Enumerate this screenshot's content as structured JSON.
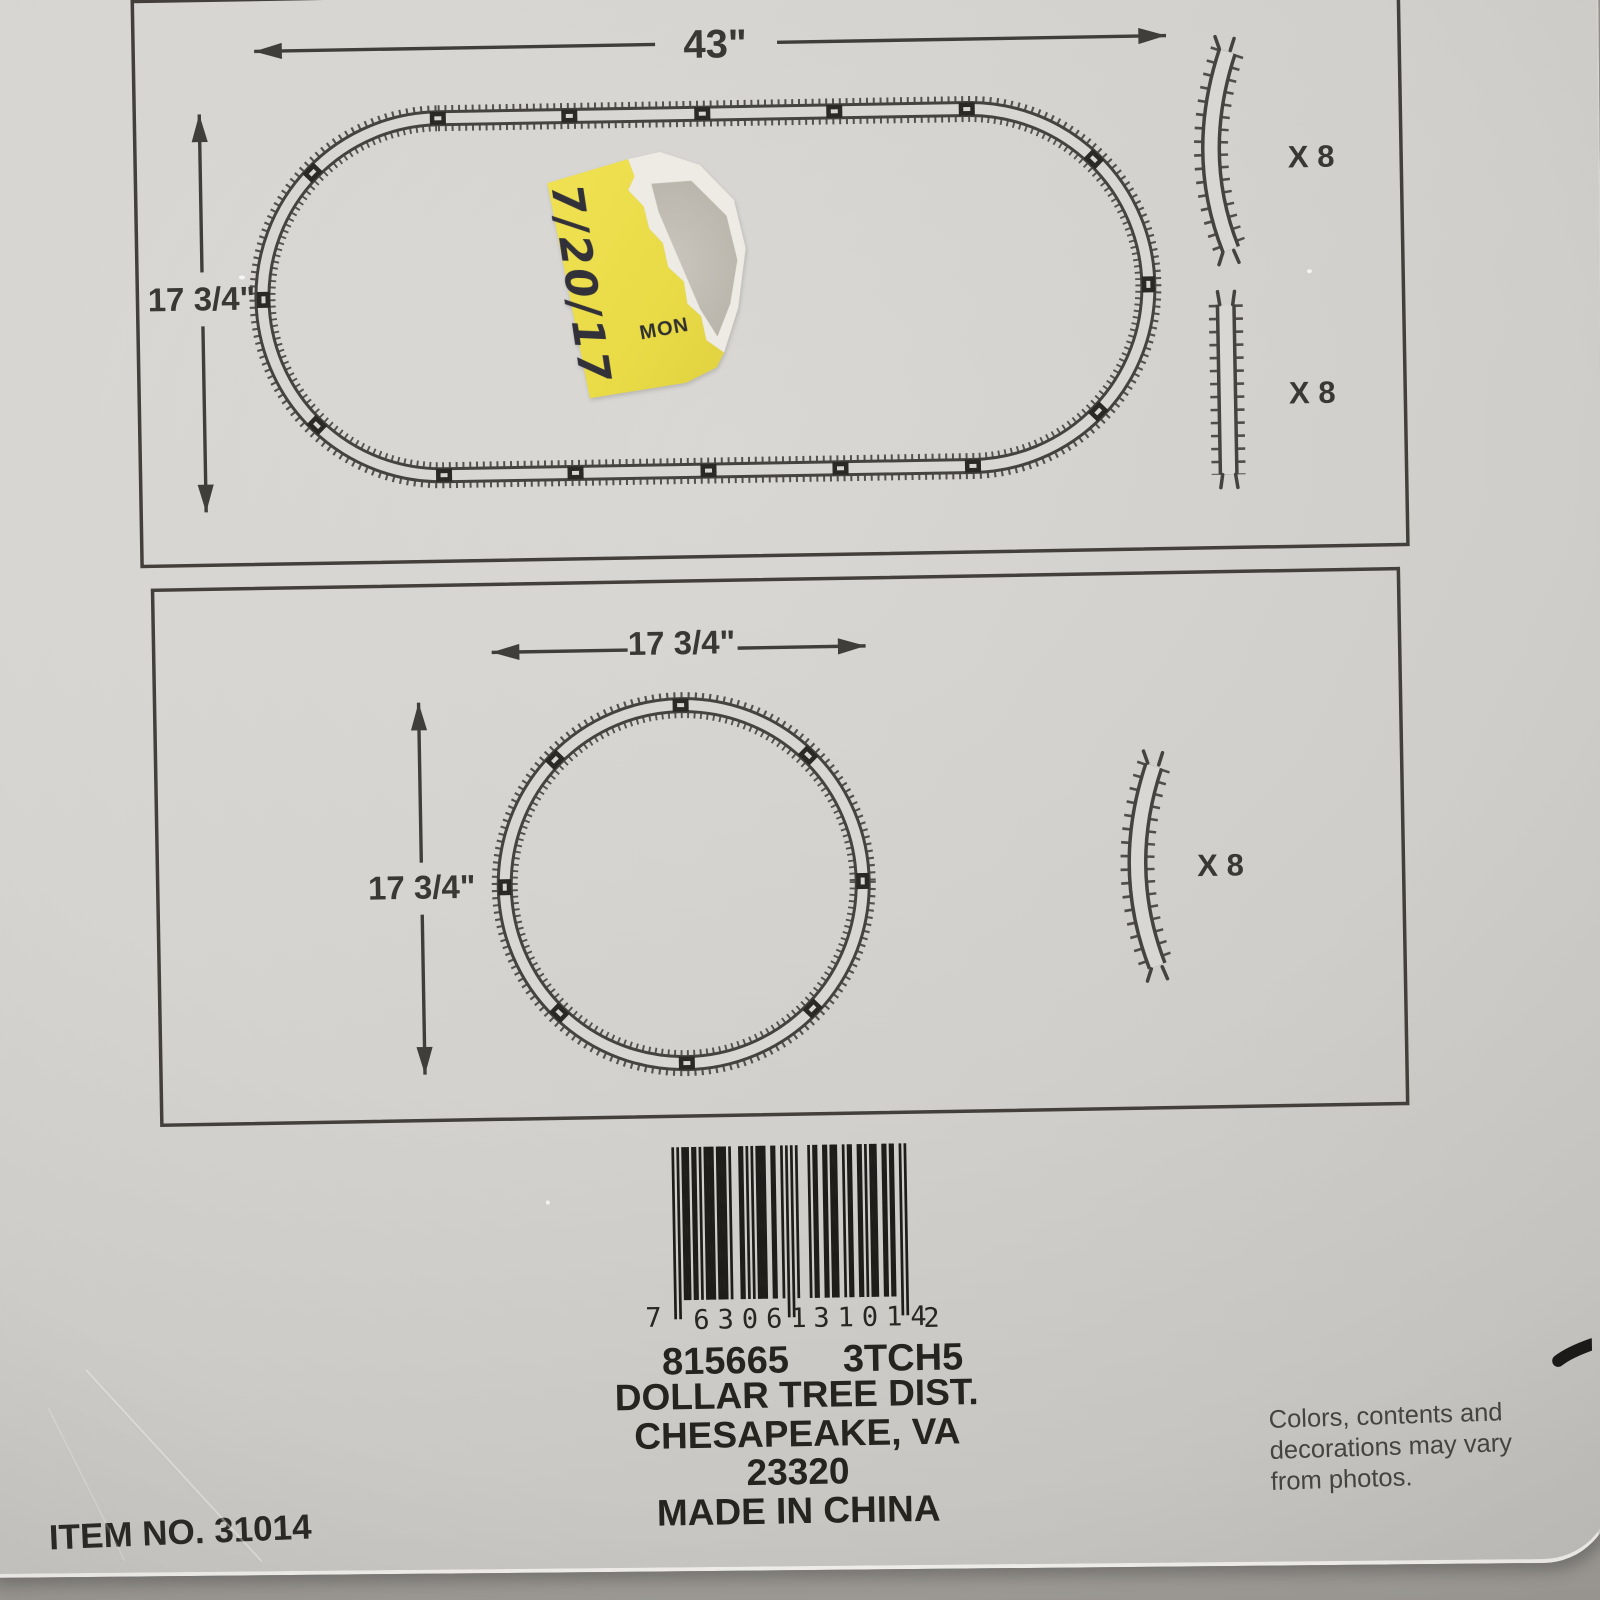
{
  "panel1": {
    "width_label": "43\"",
    "height_label": "17 3/4\"",
    "curve_qty": "X 8",
    "straight_qty": "X 8"
  },
  "panel2": {
    "width_label": "17 3/4\"",
    "height_label": "17 3/4\"",
    "curve_qty": "X 8"
  },
  "sticker": {
    "date": "7/20/17",
    "day": "MON",
    "color": "#ecdf4c"
  },
  "barcode": {
    "digits": "763061310142",
    "left_digit": "7",
    "group1": "63061",
    "group2": "31014",
    "right_digit": "2"
  },
  "footer": {
    "sku": "815665",
    "code": "3TCH5",
    "line1": "DOLLAR TREE DIST.",
    "line2": "CHESAPEAKE, VA 23320",
    "line3": "MADE IN CHINA",
    "item_no": "ITEM NO. 31014",
    "disc1": "Colors, contents and",
    "disc2": "decorations may vary",
    "disc3": "from photos."
  },
  "colors": {
    "ink": "#403e3a",
    "card": "#d7d5d1",
    "table": "#a8a5a0"
  }
}
